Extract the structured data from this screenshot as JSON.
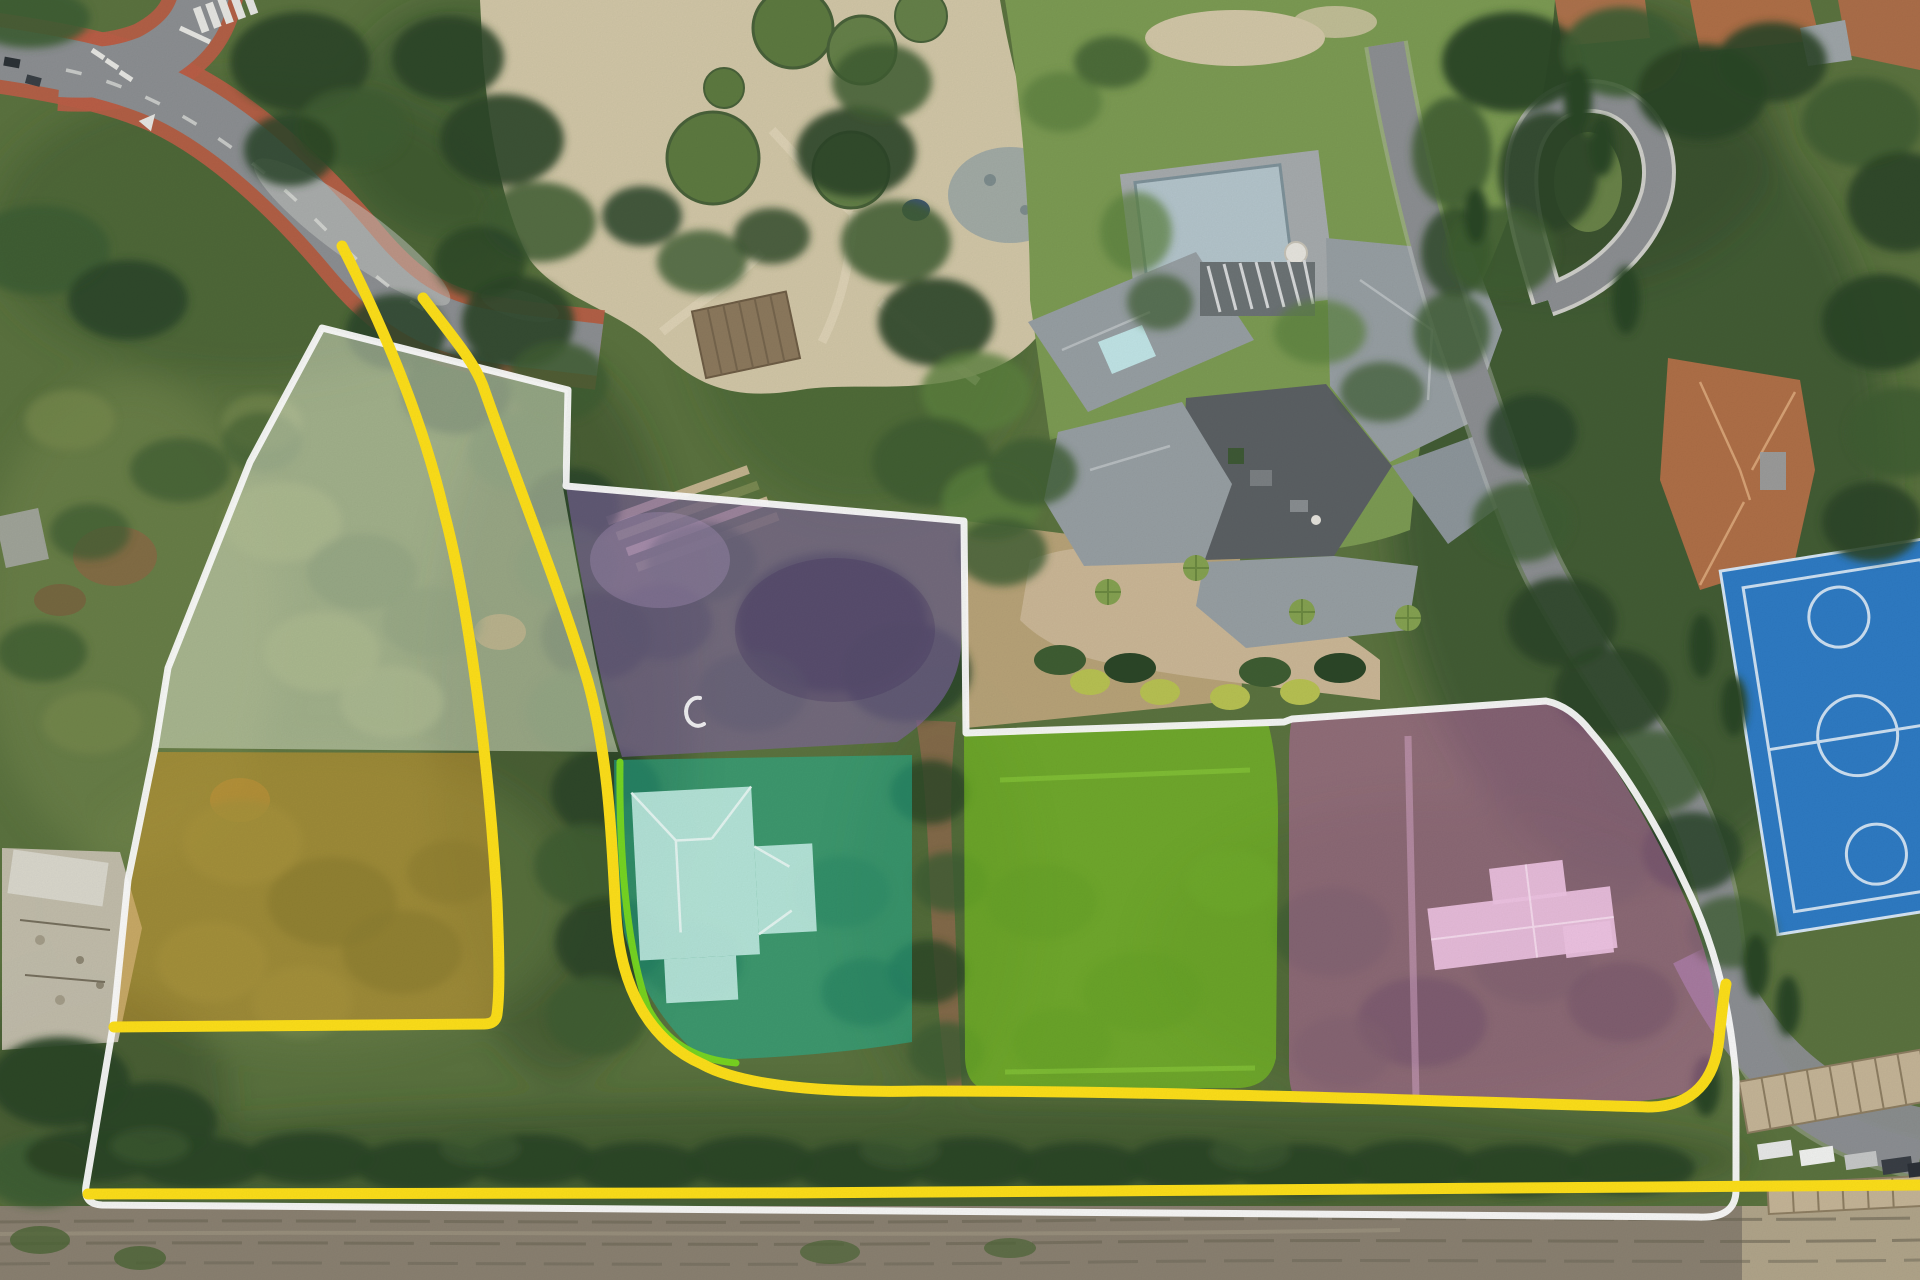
{
  "image": {
    "title": "Aerial drone view of estate with highlighted building plots",
    "width": 1920,
    "height": 1280
  },
  "legend": {
    "property_boundary": {
      "label": "property outline",
      "color": "#ffffff"
    },
    "highlight_boundary": {
      "label": "highlighted boundary line",
      "color": "#ffe11a"
    },
    "plot_edge": {
      "label": "teal plot edge line",
      "color": "#7bdb20"
    }
  },
  "parcels": [
    {
      "id": "plot-northwest",
      "label": "white/sage plot",
      "fill": "#e9efd8",
      "opacity": 0.5
    },
    {
      "id": "plot-orange",
      "label": "orange plot",
      "fill": "#d09a2f",
      "opacity": 0.55
    },
    {
      "id": "plot-purple",
      "label": "purple plot",
      "fill": "#8466a6",
      "opacity": 0.6
    },
    {
      "id": "plot-teal",
      "label": "teal plot with house",
      "fill": "#1fbd9d",
      "opacity": 0.5,
      "building": "#c6f0e8"
    },
    {
      "id": "plot-green",
      "label": "green plot",
      "fill": "#7fd01f",
      "opacity": 0.6
    },
    {
      "id": "plot-pink",
      "label": "pink plot with house",
      "fill": "#c76ab4",
      "opacity": 0.5,
      "building": "#f0c4e4"
    }
  ],
  "environment": {
    "base": "#5c7440",
    "road": "#8d9093",
    "sidewalk": "#bc5f48",
    "sand": "#d3c8a8",
    "lawn": "#7d9c54",
    "pool_water": "#b5c6cd",
    "pool_deck": "#a7acae",
    "court": "#2f7cc5",
    "roof": "#98a0a4",
    "courtyard": "#5c6164",
    "terracotta": "#b07048",
    "track": "#8b8272",
    "drive_sand": "#ccb897",
    "dirt_path": "#8a6b4d",
    "tree_colors": {
      "dark": "#2c4728",
      "mid": "#3f5e33",
      "bright": "#5d8140",
      "olive": "#75894e"
    }
  },
  "vegetation": {
    "washes": [
      [
        250,
        230,
        260,
        150,
        "mid",
        0.5
      ],
      [
        130,
        620,
        150,
        240,
        "olive",
        0.5
      ],
      [
        560,
        720,
        130,
        360,
        "dark",
        0.4
      ],
      [
        320,
        900,
        250,
        150,
        "olive",
        0.35
      ],
      [
        860,
        300,
        170,
        210,
        "mid",
        0.4
      ],
      [
        1640,
        480,
        250,
        400,
        "dark",
        0.5
      ],
      [
        1560,
        140,
        220,
        150,
        "dark",
        0.4
      ],
      [
        900,
        1160,
        850,
        60,
        "dark",
        0.45
      ],
      [
        1430,
        950,
        280,
        150,
        "mid",
        0.3
      ],
      [
        90,
        1100,
        140,
        120,
        "dark",
        0.4
      ],
      [
        460,
        120,
        120,
        120,
        "dark",
        0.35
      ],
      [
        940,
        900,
        90,
        200,
        "mid",
        0.3
      ]
    ],
    "clusters": [
      [
        30,
        18,
        60,
        30,
        "mid",
        0.9
      ],
      [
        300,
        62,
        70,
        50,
        "dark",
        0.9
      ],
      [
        352,
        128,
        55,
        40,
        "mid",
        0.85
      ],
      [
        290,
        150,
        46,
        36,
        "dark",
        0.85
      ],
      [
        40,
        250,
        70,
        45,
        "mid",
        0.9
      ],
      [
        128,
        300,
        60,
        40,
        "dark",
        0.85
      ],
      [
        448,
        58,
        56,
        42,
        "dark",
        0.9
      ],
      [
        502,
        140,
        62,
        46,
        "dark",
        0.9
      ],
      [
        540,
        222,
        56,
        40,
        "mid",
        0.85
      ],
      [
        480,
        262,
        46,
        36,
        "dark",
        0.8
      ],
      [
        518,
        322,
        56,
        46,
        "dark",
        0.9
      ],
      [
        558,
        382,
        50,
        40,
        "mid",
        0.85
      ],
      [
        396,
        332,
        50,
        38,
        "dark",
        0.85
      ],
      [
        456,
        392,
        55,
        42,
        "dark",
        0.85
      ],
      [
        520,
        452,
        52,
        40,
        "mid",
        0.8
      ],
      [
        572,
        506,
        48,
        38,
        "dark",
        0.85
      ],
      [
        566,
        566,
        50,
        40,
        "mid",
        0.85
      ],
      [
        596,
        636,
        55,
        45,
        "dark",
        0.9
      ],
      [
        576,
        712,
        50,
        42,
        "mid",
        0.85
      ],
      [
        606,
        792,
        55,
        45,
        "dark",
        0.9
      ],
      [
        586,
        866,
        52,
        42,
        "mid",
        0.85
      ],
      [
        610,
        942,
        55,
        45,
        "dark",
        0.9
      ],
      [
        596,
        1016,
        50,
        40,
        "mid",
        0.85
      ],
      [
        930,
        792,
        40,
        32,
        "dark",
        0.8
      ],
      [
        950,
        882,
        38,
        30,
        "mid",
        0.8
      ],
      [
        928,
        972,
        40,
        32,
        "dark",
        0.8
      ],
      [
        946,
        1052,
        38,
        30,
        "mid",
        0.8
      ],
      [
        70,
        420,
        45,
        30,
        "olive",
        0.8
      ],
      [
        180,
        470,
        50,
        32,
        "mid",
        0.7
      ],
      [
        90,
        532,
        40,
        28,
        "mid",
        0.7
      ],
      [
        262,
        422,
        40,
        28,
        "olive",
        0.7
      ],
      [
        42,
        652,
        45,
        30,
        "mid",
        0.75
      ],
      [
        92,
        722,
        50,
        32,
        "olive",
        0.8
      ],
      [
        60,
        1082,
        70,
        45,
        "dark",
        0.95
      ],
      [
        152,
        1122,
        65,
        40,
        "dark",
        0.95
      ],
      [
        40,
        1172,
        55,
        35,
        "mid",
        0.9
      ],
      [
        282,
        522,
        60,
        40,
        "olive",
        0.75
      ],
      [
        362,
        572,
        55,
        38,
        "mid",
        0.65
      ],
      [
        322,
        652,
        58,
        40,
        "olive",
        0.75
      ],
      [
        432,
        622,
        50,
        35,
        "mid",
        0.6
      ],
      [
        392,
        702,
        52,
        36,
        "olive",
        0.7
      ],
      [
        262,
        442,
        40,
        30,
        "mid",
        0.55
      ],
      [
        242,
        842,
        60,
        42,
        "olive",
        0.8
      ],
      [
        332,
        902,
        65,
        45,
        "mid",
        0.7
      ],
      [
        212,
        962,
        55,
        40,
        "olive",
        0.8
      ],
      [
        402,
        952,
        60,
        42,
        "mid",
        0.7
      ],
      [
        302,
        1002,
        50,
        36,
        "olive",
        0.75
      ],
      [
        452,
        872,
        45,
        32,
        "mid",
        0.6
      ],
      [
        702,
        562,
        55,
        40,
        "mid",
        0.75
      ],
      [
        662,
        622,
        50,
        38,
        "dark",
        0.65
      ],
      [
        832,
        622,
        95,
        70,
        "dark",
        0.9
      ],
      [
        906,
        672,
        65,
        50,
        "dark",
        0.85
      ],
      [
        752,
        692,
        55,
        40,
        "mid",
        0.7
      ],
      [
        652,
        832,
        45,
        35,
        "mid",
        0.7
      ],
      [
        692,
        962,
        50,
        38,
        "dark",
        0.6
      ],
      [
        842,
        892,
        48,
        36,
        "mid",
        0.7
      ],
      [
        866,
        992,
        45,
        34,
        "dark",
        0.6
      ],
      [
        1042,
        902,
        55,
        38,
        "mid",
        0.45
      ],
      [
        1142,
        992,
        60,
        40,
        "mid",
        0.4
      ],
      [
        1232,
        882,
        45,
        32,
        "bright",
        0.45
      ],
      [
        1062,
        1042,
        50,
        34,
        "mid",
        0.4
      ],
      [
        1332,
        932,
        60,
        45,
        "mid",
        0.7
      ],
      [
        1422,
        1022,
        65,
        45,
        "dark",
        0.65
      ],
      [
        1532,
        962,
        60,
        42,
        "mid",
        0.65
      ],
      [
        1622,
        1002,
        55,
        40,
        "dark",
        0.6
      ],
      [
        1342,
        1052,
        50,
        36,
        "mid",
        0.6
      ],
      [
        1602,
        872,
        45,
        34,
        "mid",
        0.55
      ],
      [
        856,
        152,
        60,
        45,
        "dark",
        0.9
      ],
      [
        896,
        242,
        55,
        42,
        "mid",
        0.85
      ],
      [
        936,
        322,
        58,
        44,
        "dark",
        0.9
      ],
      [
        882,
        82,
        50,
        38,
        "mid",
        0.85
      ],
      [
        976,
        392,
        55,
        40,
        "bright",
        0.8
      ],
      [
        932,
        462,
        60,
        45,
        "mid",
        0.85
      ],
      [
        992,
        502,
        50,
        38,
        "bright",
        0.8
      ],
      [
        1032,
        472,
        45,
        34,
        "mid",
        0.8
      ],
      [
        1002,
        552,
        45,
        34,
        "mid",
        0.8
      ],
      [
        642,
        216,
        40,
        30,
        "dark",
        0.85
      ],
      [
        702,
        262,
        45,
        32,
        "mid",
        0.8
      ],
      [
        772,
        236,
        38,
        28,
        "dark",
        0.8
      ],
      [
        1062,
        102,
        40,
        30,
        "bright",
        0.75
      ],
      [
        1112,
        62,
        38,
        26,
        "mid",
        0.75
      ],
      [
        1452,
        152,
        40,
        55,
        "mid",
        0.85
      ],
      [
        1456,
        252,
        35,
        45,
        "dark",
        0.8
      ],
      [
        1452,
        332,
        38,
        40,
        "mid",
        0.8
      ],
      [
        1136,
        232,
        36,
        40,
        "bright",
        0.7
      ],
      [
        1160,
        302,
        33,
        28,
        "mid",
        0.7
      ],
      [
        1320,
        332,
        46,
        32,
        "bright",
        0.7
      ],
      [
        1382,
        392,
        42,
        30,
        "mid",
        0.7
      ],
      [
        1512,
        62,
        70,
        50,
        "dark",
        0.95
      ],
      [
        1622,
        52,
        60,
        45,
        "mid",
        0.9
      ],
      [
        1702,
        92,
        65,
        48,
        "dark",
        0.95
      ],
      [
        1772,
        62,
        55,
        40,
        "dark",
        0.9
      ],
      [
        1548,
        172,
        50,
        60,
        "dark",
        0.9
      ],
      [
        1502,
        252,
        55,
        45,
        "mid",
        0.85
      ],
      [
        1862,
        122,
        60,
        45,
        "mid",
        0.85
      ],
      [
        1902,
        202,
        55,
        50,
        "dark",
        0.9
      ],
      [
        1882,
        322,
        60,
        48,
        "dark",
        0.95
      ],
      [
        1902,
        432,
        55,
        45,
        "mid",
        0.85
      ],
      [
        1872,
        522,
        50,
        40,
        "dark",
        0.9
      ],
      [
        1532,
        432,
        45,
        38,
        "dark",
        0.85
      ],
      [
        1522,
        522,
        50,
        40,
        "mid",
        0.8
      ],
      [
        1562,
        622,
        55,
        45,
        "dark",
        0.9
      ],
      [
        1612,
        692,
        58,
        45,
        "dark",
        0.9
      ],
      [
        1652,
        772,
        55,
        42,
        "mid",
        0.8
      ],
      [
        1692,
        852,
        50,
        40,
        "dark",
        0.85
      ],
      [
        1732,
        932,
        45,
        36,
        "mid",
        0.75
      ],
      [
        1578,
        100,
        14,
        34,
        "dark",
        1
      ],
      [
        1602,
        146,
        13,
        30,
        "dark",
        1
      ],
      [
        1626,
        300,
        14,
        34,
        "dark",
        1
      ],
      [
        1476,
        216,
        12,
        28,
        "dark",
        1
      ],
      [
        1702,
        646,
        13,
        32,
        "dark",
        1
      ],
      [
        1734,
        706,
        13,
        30,
        "dark",
        1
      ],
      [
        1756,
        966,
        13,
        32,
        "dark",
        1
      ],
      [
        1788,
        1006,
        12,
        30,
        "dark",
        1
      ],
      [
        1706,
        1086,
        14,
        30,
        "dark",
        1
      ],
      [
        90,
        1156,
        65,
        26,
        "dark",
        0.95
      ],
      [
        200,
        1163,
        65,
        26,
        "dark",
        0.95
      ],
      [
        310,
        1158,
        65,
        26,
        "dark",
        0.95
      ],
      [
        420,
        1166,
        65,
        26,
        "dark",
        0.95
      ],
      [
        530,
        1160,
        65,
        26,
        "dark",
        0.95
      ],
      [
        640,
        1168,
        65,
        26,
        "dark",
        0.95
      ],
      [
        750,
        1162,
        65,
        26,
        "dark",
        0.95
      ],
      [
        860,
        1168,
        65,
        26,
        "dark",
        0.95
      ],
      [
        970,
        1163,
        65,
        26,
        "dark",
        0.95
      ],
      [
        1080,
        1168,
        65,
        26,
        "dark",
        0.95
      ],
      [
        1190,
        1164,
        65,
        26,
        "dark",
        0.95
      ],
      [
        1300,
        1170,
        65,
        26,
        "dark",
        0.95
      ],
      [
        1410,
        1166,
        65,
        26,
        "dark",
        0.95
      ],
      [
        1520,
        1170,
        65,
        26,
        "dark",
        0.95
      ],
      [
        1630,
        1168,
        65,
        26,
        "dark",
        0.95
      ],
      [
        150,
        1146,
        40,
        18,
        "mid",
        0.6
      ],
      [
        480,
        1148,
        40,
        18,
        "mid",
        0.6
      ],
      [
        900,
        1150,
        40,
        18,
        "mid",
        0.6
      ],
      [
        1250,
        1152,
        40,
        18,
        "mid",
        0.6
      ]
    ]
  }
}
